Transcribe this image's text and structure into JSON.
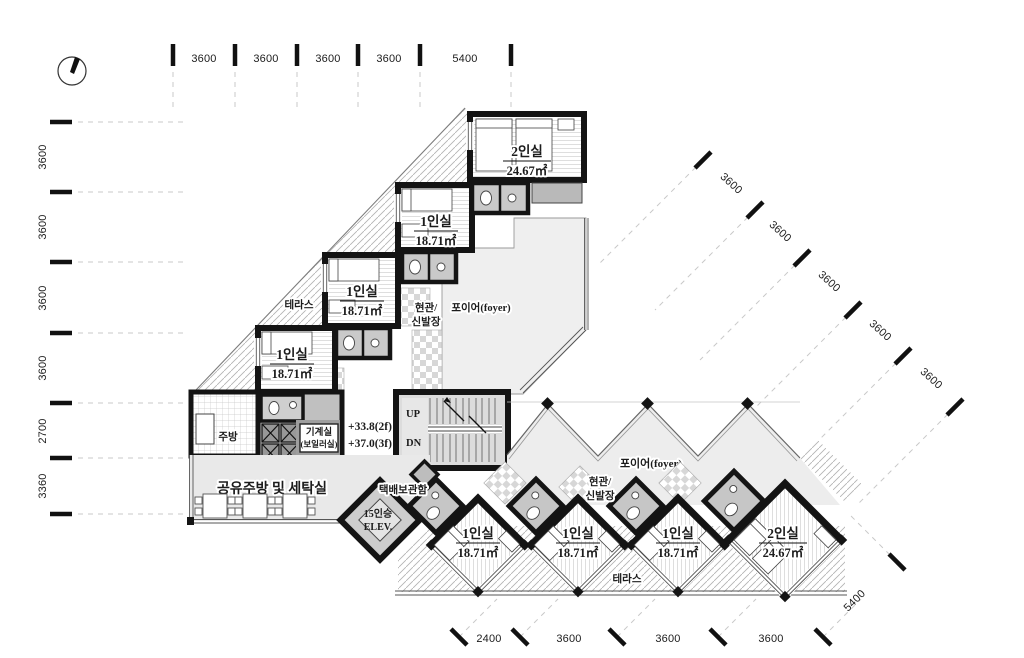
{
  "drawing": {
    "type": "architectural-floor-plan",
    "wall_color": "#141414",
    "foyer_fill": "#eeeeee",
    "pod_fill": "#c6c6c6"
  },
  "dims": {
    "top": [
      "3600",
      "3600",
      "3600",
      "3600",
      "5400"
    ],
    "left": [
      "3600",
      "3600",
      "3600",
      "3600",
      "2700",
      "3360"
    ],
    "right_diagonal": [
      "3600",
      "3600",
      "3600",
      "3600",
      "3600"
    ],
    "bottom": [
      "2400",
      "3600",
      "3600",
      "3600"
    ],
    "bottom_right": "5400"
  },
  "levels": {
    "l1": "+33.8(2f)",
    "l2": "+37.0(3f)"
  },
  "stairs": {
    "up": "UP",
    "dn": "DN"
  },
  "elevator": {
    "line1": "15인승",
    "line2": "ELEV."
  },
  "labels": {
    "terrace_upper": "테라스",
    "terrace_lower": "테라스",
    "foyer_upper": "포이어(foyer)",
    "foyer_lower": "포이어(foyer)",
    "entrance_upper_1": "현관/",
    "entrance_upper_2": "신발장",
    "entrance_lower_1": "현관/",
    "entrance_lower_2": "신발장",
    "kitchen": "주방",
    "machine_1": "기계실",
    "machine_2": "(보일러실)",
    "laundry": "세탁/건조기",
    "shared_kitchen": "공유주방 및 세탁실",
    "parcel": "택배보관함"
  },
  "rooms": {
    "upper": [
      {
        "name": "1인실",
        "area": "18.71㎡"
      },
      {
        "name": "1인실",
        "area": "18.71㎡"
      },
      {
        "name": "1인실",
        "area": "18.71㎡"
      },
      {
        "name": "2인실",
        "area": "24.67㎡"
      }
    ],
    "lower": [
      {
        "name": "1인실",
        "area": "18.71㎡"
      },
      {
        "name": "1인실",
        "area": "18.71㎡"
      },
      {
        "name": "1인실",
        "area": "18.71㎡"
      },
      {
        "name": "2인실",
        "area": "24.67㎡"
      }
    ]
  }
}
